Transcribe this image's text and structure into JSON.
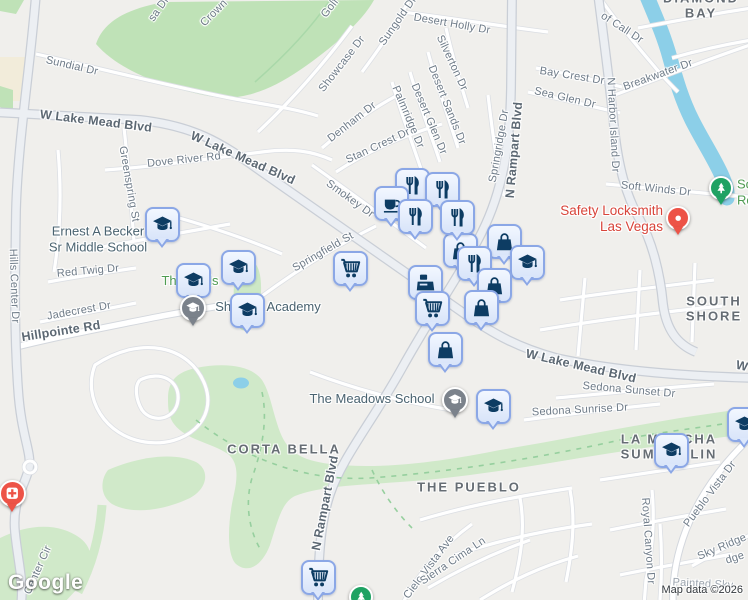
{
  "map": {
    "logo": "Google",
    "attribution": "Map data ©2026",
    "colors": {
      "land": "#f0efec",
      "water": "#8ccfe8",
      "park_green": "#bfe2b7",
      "wash_green": "#d0e9c9",
      "marker_fill": "#dce8fb",
      "marker_border": "#8ba7e6",
      "marker_icon": "#0d3c63",
      "school_pin": "#7b828b",
      "park_pin": "#1fa263",
      "business_pin": "#ed5347",
      "street_text": "#6e7b88",
      "district_text": "#666d74",
      "school_text": "#4a6370",
      "park_text": "#4f9b51",
      "business_text": "#d8443a"
    },
    "street_labels": [
      {
        "t": "Sundial Dr",
        "x": 72,
        "y": 66,
        "r": 13
      },
      {
        "t": "W Lake Mead Blvd",
        "x": 96,
        "y": 121,
        "r": 7,
        "k": "maj"
      },
      {
        "t": "W Lake Mead Blvd",
        "x": 243,
        "y": 158,
        "r": 24,
        "k": "maj"
      },
      {
        "t": "Dove River Rd",
        "x": 184,
        "y": 160,
        "r": -6
      },
      {
        "t": "Greenspring St",
        "x": 129,
        "y": 184,
        "r": 80
      },
      {
        "t": "Hills Center Dr",
        "x": 14,
        "y": 286,
        "r": 88
      },
      {
        "t": "Red Twig Dr",
        "x": 88,
        "y": 271,
        "r": -5
      },
      {
        "t": "Jadecrest Dr",
        "x": 79,
        "y": 311,
        "r": -10
      },
      {
        "t": "Hillpointe Rd",
        "x": 61,
        "y": 331,
        "r": -9,
        "k": "maj"
      },
      {
        "t": "Center Cir",
        "x": 38,
        "y": 570,
        "r": -66
      },
      {
        "t": "Showcase Dr",
        "x": 342,
        "y": 64,
        "r": -52
      },
      {
        "t": "Sungold Dr",
        "x": 398,
        "y": 21,
        "r": -55
      },
      {
        "t": "Golf",
        "x": 330,
        "y": 8,
        "r": -52
      },
      {
        "t": "Crown",
        "x": 214,
        "y": 13,
        "r": -45
      },
      {
        "t": "sa Dr",
        "x": 159,
        "y": 9,
        "r": -55
      },
      {
        "t": "Desert Holly Dr",
        "x": 452,
        "y": 24,
        "r": 10
      },
      {
        "t": "Silverton Dr",
        "x": 452,
        "y": 63,
        "r": 65
      },
      {
        "t": "Desert Sands Dr",
        "x": 447,
        "y": 105,
        "r": 68
      },
      {
        "t": "Desert Glen Dr",
        "x": 429,
        "y": 119,
        "r": 67
      },
      {
        "t": "Palmridge Dr",
        "x": 408,
        "y": 117,
        "r": 67
      },
      {
        "t": "Denham Dr",
        "x": 352,
        "y": 122,
        "r": -38
      },
      {
        "t": "Stan Crest Dr",
        "x": 378,
        "y": 146,
        "r": -25
      },
      {
        "t": "Smokey Dr",
        "x": 350,
        "y": 199,
        "r": 36
      },
      {
        "t": "Springfield St",
        "x": 323,
        "y": 252,
        "r": -30
      },
      {
        "t": "Springridge Dr",
        "x": 499,
        "y": 146,
        "r": -80
      },
      {
        "t": "N Rampart Blvd",
        "x": 514,
        "y": 150,
        "r": -85,
        "k": "maj"
      },
      {
        "t": "of Call Dr",
        "x": 622,
        "y": 28,
        "r": 33
      },
      {
        "t": "Bay Crest Dr",
        "x": 572,
        "y": 76,
        "r": 9
      },
      {
        "t": "Sea Glen Dr",
        "x": 565,
        "y": 98,
        "r": 13
      },
      {
        "t": "Breakwater Dr",
        "x": 658,
        "y": 75,
        "r": -20
      },
      {
        "t": "N Harbor Island Dr",
        "x": 613,
        "y": 125,
        "r": 87
      },
      {
        "t": "Soft Winds Dr",
        "x": 656,
        "y": 189,
        "r": 6
      },
      {
        "t": "W Lake Mead Blvd",
        "x": 581,
        "y": 366,
        "r": 13,
        "k": "maj"
      },
      {
        "t": "W",
        "x": 742,
        "y": 366,
        "r": 13,
        "k": "maj"
      },
      {
        "t": "Sedona Sunset Dr",
        "x": 629,
        "y": 390,
        "r": 5
      },
      {
        "t": "Sedona Sunrise Dr",
        "x": 580,
        "y": 410,
        "r": -3
      },
      {
        "t": "N Rampart Blvd",
        "x": 325,
        "y": 503,
        "r": -79,
        "k": "maj"
      },
      {
        "t": "Cielo Vista Ave",
        "x": 429,
        "y": 567,
        "r": -53
      },
      {
        "t": "Sierra Cima Ln",
        "x": 453,
        "y": 561,
        "r": -34
      },
      {
        "t": "Royal Canyon Dr",
        "x": 648,
        "y": 541,
        "r": 86
      },
      {
        "t": "Pueblo Vista Dr",
        "x": 710,
        "y": 494,
        "r": -53
      },
      {
        "t": "Sky Ridge",
        "x": 722,
        "y": 547,
        "r": -23
      },
      {
        "t": "dge",
        "x": 735,
        "y": 558,
        "r": -18
      },
      {
        "t": "Painted Sky",
        "x": 703,
        "y": 584,
        "r": 3,
        "k": "faint"
      }
    ],
    "district_labels": [
      {
        "lines": [
          "DIAMOND BAY"
        ],
        "x": 701,
        "y": 6
      },
      {
        "lines": [
          "SOUTH SHORE"
        ],
        "x": 714,
        "y": 309
      },
      {
        "lines": [
          "CORTA BELLA"
        ],
        "x": 284,
        "y": 449
      },
      {
        "lines": [
          "THE PUEBLO"
        ],
        "x": 469,
        "y": 487
      },
      {
        "lines": [
          "LA MANCHA",
          "SUMMERLIN"
        ],
        "x": 669,
        "y": 447
      }
    ],
    "poi_labels": [
      {
        "lines": [
          "Ernest A Becker",
          "Sr Middle School"
        ],
        "x": 98,
        "y": 239,
        "cls": "school"
      },
      {
        "lines": [
          "The Trails"
        ],
        "x": 190,
        "y": 281,
        "cls": "park"
      },
      {
        "lines": [
          "Shenker Academy"
        ],
        "x": 268,
        "y": 307,
        "cls": "school"
      },
      {
        "lines": [
          "The Meadows School"
        ],
        "x": 372,
        "y": 399,
        "cls": "school"
      },
      {
        "lines": [
          "Safety Locksmith",
          "Las Vegas"
        ],
        "x": 663,
        "y": 219,
        "cls": "business",
        "align": "right"
      },
      {
        "lines": [
          "So",
          "Ro"
        ],
        "x": 737,
        "y": 192,
        "cls": "park",
        "align": "left"
      }
    ],
    "markers": [
      {
        "kind": "square",
        "icon": "restaurant",
        "x": 412,
        "y": 185,
        "name": "restaurant-poi-marker"
      },
      {
        "kind": "square",
        "icon": "restaurant",
        "x": 442,
        "y": 189,
        "name": "restaurant-poi-marker"
      },
      {
        "kind": "square",
        "icon": "bag",
        "x": 504,
        "y": 241,
        "name": "shopping-bag-poi-marker"
      },
      {
        "kind": "square",
        "icon": "coffee",
        "x": 391,
        "y": 203,
        "name": "cafe-poi-marker"
      },
      {
        "kind": "square",
        "icon": "school",
        "x": 527,
        "y": 262,
        "name": "school-poi-marker"
      },
      {
        "kind": "square",
        "icon": "bag",
        "x": 460,
        "y": 250,
        "name": "shopping-bag-poi-marker"
      },
      {
        "kind": "square",
        "icon": "restaurant",
        "x": 474,
        "y": 263,
        "name": "restaurant-poi-marker"
      },
      {
        "kind": "square",
        "icon": "restaurant",
        "x": 415,
        "y": 216,
        "name": "restaurant-poi-marker"
      },
      {
        "kind": "square",
        "icon": "restaurant",
        "x": 457,
        "y": 217,
        "name": "restaurant-poi-marker"
      },
      {
        "kind": "square",
        "icon": "bag",
        "x": 494,
        "y": 285,
        "name": "shopping-bag-poi-marker"
      },
      {
        "kind": "square",
        "icon": "register",
        "x": 425,
        "y": 282,
        "name": "store-poi-marker"
      },
      {
        "kind": "square",
        "icon": "bag",
        "x": 481,
        "y": 307,
        "name": "shopping-bag-poi-marker"
      },
      {
        "kind": "square",
        "icon": "cart",
        "x": 432,
        "y": 308,
        "name": "grocery-poi-marker"
      },
      {
        "kind": "square",
        "icon": "bag",
        "x": 445,
        "y": 349,
        "name": "shopping-bag-poi-marker"
      },
      {
        "kind": "square",
        "icon": "cart",
        "x": 350,
        "y": 268,
        "name": "grocery-poi-marker"
      },
      {
        "kind": "square",
        "icon": "school",
        "x": 162,
        "y": 224,
        "name": "school-poi-marker"
      },
      {
        "kind": "square",
        "icon": "school",
        "x": 238,
        "y": 267,
        "name": "school-poi-marker"
      },
      {
        "kind": "square",
        "icon": "school",
        "x": 193,
        "y": 280,
        "name": "school-poi-marker"
      },
      {
        "kind": "pin",
        "icon": "school",
        "x": 193,
        "y": 308,
        "color": "school_pin",
        "size": 26,
        "name": "school-pin-shenker-academy"
      },
      {
        "kind": "square",
        "icon": "school",
        "x": 247,
        "y": 310,
        "name": "school-poi-marker"
      },
      {
        "kind": "pin",
        "icon": "school",
        "x": 455,
        "y": 400,
        "color": "school_pin",
        "size": 26,
        "name": "school-pin-the-meadows-school"
      },
      {
        "kind": "square",
        "icon": "school",
        "x": 493,
        "y": 406,
        "name": "school-poi-marker"
      },
      {
        "kind": "square",
        "icon": "school",
        "x": 671,
        "y": 450,
        "name": "school-poi-marker"
      },
      {
        "kind": "square",
        "icon": "school",
        "x": 744,
        "y": 424,
        "name": "school-poi-marker"
      },
      {
        "kind": "square",
        "icon": "cart",
        "x": 318,
        "y": 577,
        "name": "grocery-poi-marker"
      },
      {
        "kind": "pin",
        "icon": "tree",
        "x": 721,
        "y": 188,
        "color": "park_pin",
        "size": 24,
        "name": "park-pin"
      },
      {
        "kind": "pin",
        "icon": "tree",
        "x": 361,
        "y": 597,
        "color": "park_pin",
        "size": 24,
        "name": "park-pin"
      },
      {
        "kind": "pin",
        "icon": "dot",
        "x": 678,
        "y": 218,
        "color": "business_pin",
        "size": 24,
        "name": "business-pin-safety-locksmith"
      },
      {
        "kind": "pin",
        "icon": "hospital",
        "x": 12,
        "y": 493,
        "color": "business_pin",
        "size": 27,
        "name": "hospital-pin"
      }
    ]
  }
}
